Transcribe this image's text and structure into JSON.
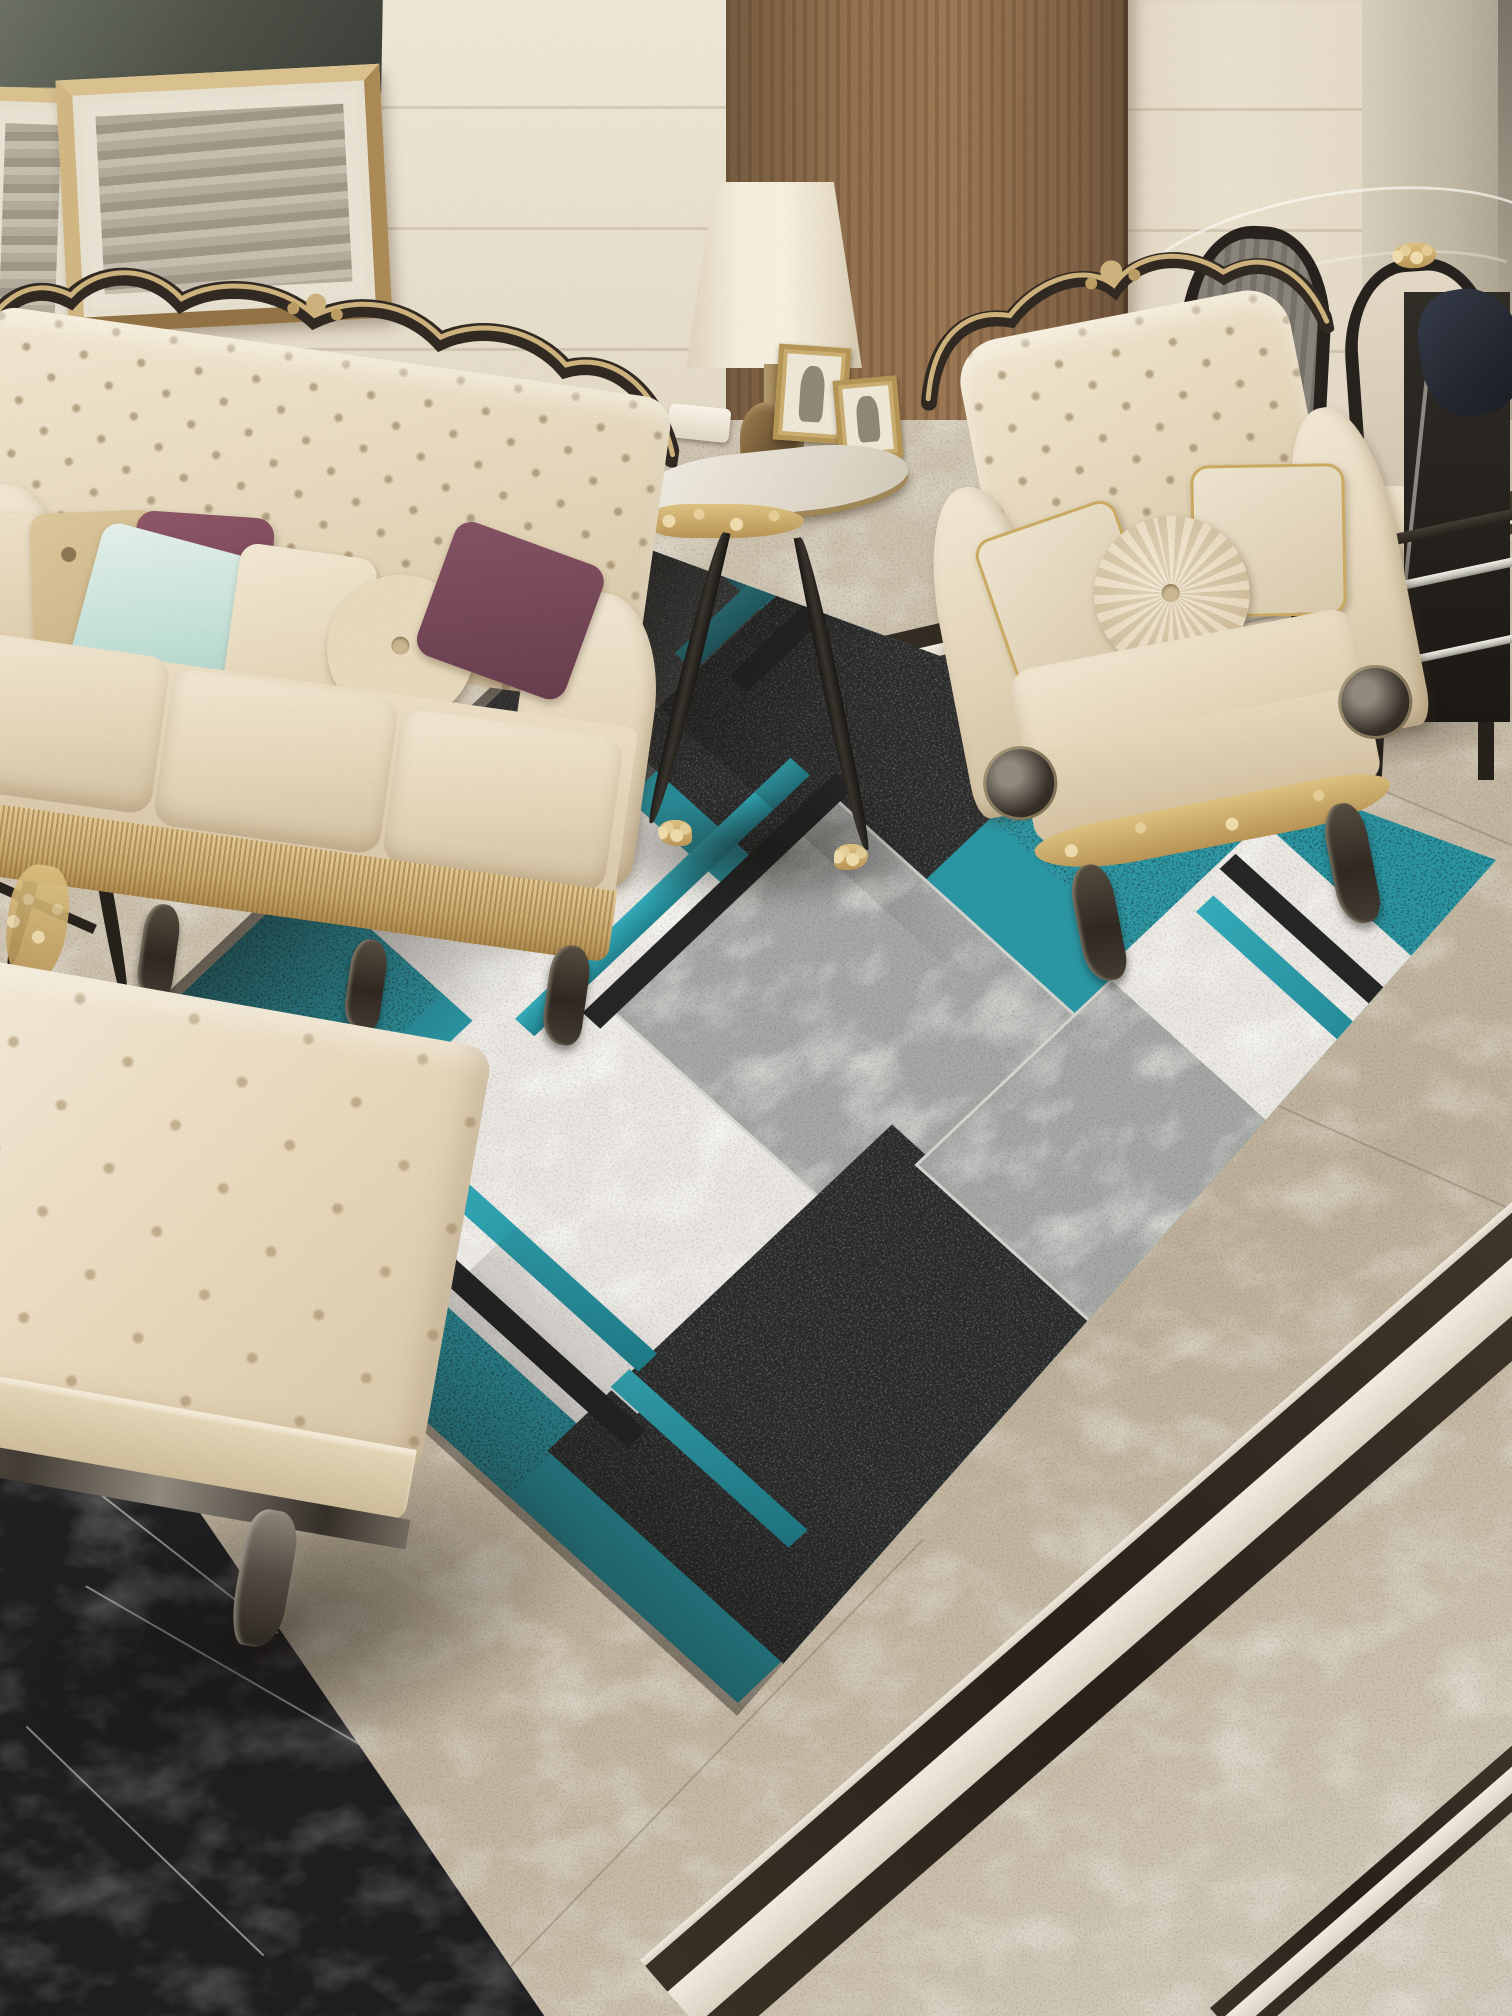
{
  "image": {
    "type": "photograph",
    "subject": "Luxury classic living room with teal-gray geometric area rug",
    "visible_text": "none"
  },
  "scene": {
    "walls": {
      "tile_color": "#e9e0cf",
      "door_color": "#8d6a47",
      "corner_marble_color": "#a29a89"
    },
    "wall_art": {
      "count": 3,
      "frame_color": "#c9ab6b",
      "large_art_color": "#434840"
    },
    "sofa": {
      "style": "ornate tufted chesterfield",
      "upholstery_color": "#ecdfc6",
      "trim_colors": [
        "#241d17",
        "#cdb079"
      ],
      "seat_cushions": 3,
      "pillows": [
        "gold-damask",
        "light-teal",
        "maroon",
        "cream",
        "round-cream-button",
        "plum"
      ]
    },
    "armchair": {
      "style": "ornate tufted wingback",
      "upholstery_color": "#ecdfc6",
      "apron_color": "#dec27f",
      "pillows": [
        "cream-gold-trim-left",
        "round-cream-button-center",
        "cream-gold-trim-right"
      ]
    },
    "side_table": {
      "top_color": "#f2eee6",
      "leg_color": "#1f1b18",
      "accents": "#c9a85c",
      "items": [
        "table-lamp",
        "photo-frame-large",
        "photo-frame-small",
        "white-box"
      ]
    },
    "lamp": {
      "shade_color": "#f6efe0",
      "base_color": "#5e4526"
    },
    "dining_set": {
      "glass_table": true,
      "chrome_rails": 2,
      "chairs": 2,
      "chair_frame_color": "#191512",
      "chair_panel_color": "#ddd3c2",
      "cloth_color": "#1e2430"
    },
    "ottoman": {
      "style": "tufted bench",
      "top_color": "#f2ead8",
      "base_color": "#4c463e"
    },
    "rug": {
      "style": "modern geometric patchwork, rotated in perspective",
      "patch_colors": {
        "teal": "#1f93a3",
        "black": "#212426",
        "dark_gray": "#45494c",
        "gray_marble": "#a3a7a6",
        "white_marble": "#eceae6"
      },
      "stripe_colors": {
        "teal": "#29a9ba",
        "black": "#191b1d"
      },
      "patches": [
        "teal-top-left",
        "white-striped-upper",
        "dark-gray-upper",
        "black-upper",
        "teal-right-large",
        "gray-center",
        "white-left-large",
        "teal-left-corner",
        "black-bottom-large",
        "gray-bottom-right",
        "white-right-striped",
        "teal-bottom-right"
      ]
    },
    "floor": {
      "tile_color": "#c9beaa",
      "black_marble_color": "#15161a",
      "border_band_colors": [
        "#1f1913",
        "#f4efe4"
      ]
    }
  }
}
